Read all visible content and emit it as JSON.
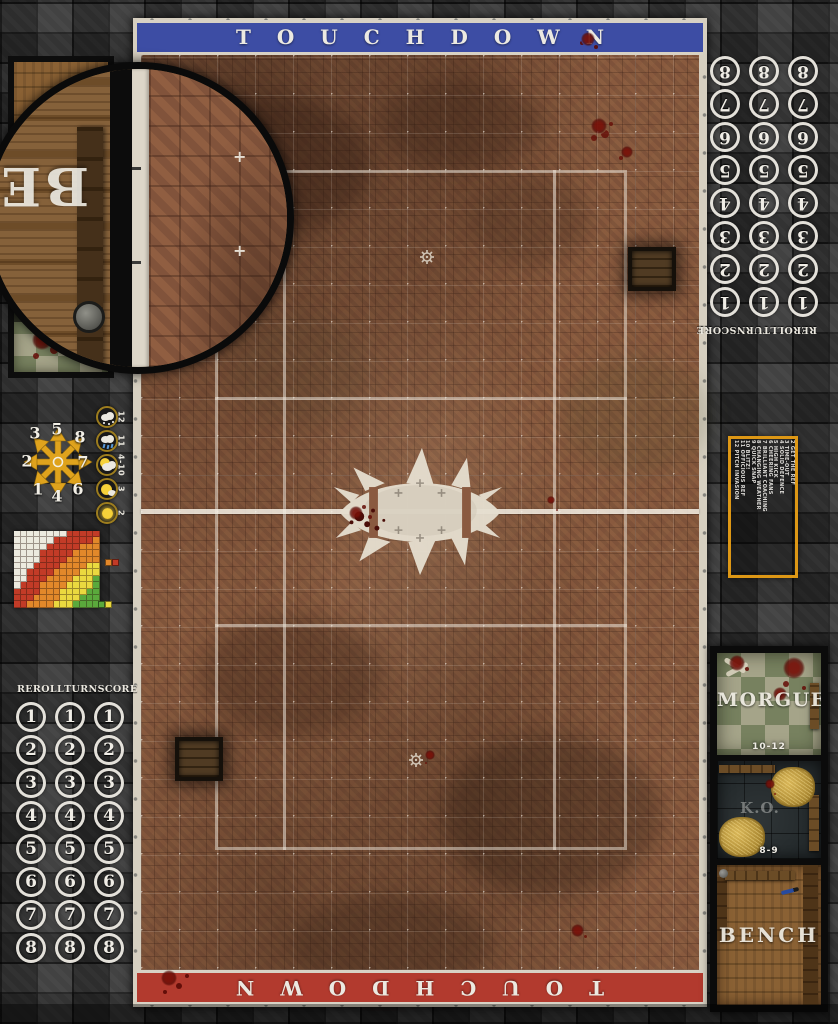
{
  "board": {
    "top_banner": {
      "label": "TOUCHDOWN",
      "color": "#3d4da4"
    },
    "bottom_banner": {
      "label": "TOUCHDOWN",
      "color": "#b23a2e"
    }
  },
  "turn_track": {
    "columns": [
      "REROLL",
      "TURN",
      "SCORE"
    ],
    "numbers": [
      "1",
      "2",
      "3",
      "4",
      "5",
      "6",
      "7",
      "8"
    ]
  },
  "scatter_template": {
    "numbers": [
      "1",
      "2",
      "3",
      "4",
      "5",
      "6",
      "7",
      "8"
    ]
  },
  "weather_track": {
    "entries": [
      {
        "value": "12",
        "icon": "blizzard-icon"
      },
      {
        "value": "11",
        "icon": "rain-icon"
      },
      {
        "value": "4-10",
        "icon": "overcast-icon"
      },
      {
        "value": "3",
        "icon": "sunny-icon"
      },
      {
        "value": "2",
        "icon": "sweltering-icon"
      }
    ]
  },
  "range_ruler": {
    "legend_colors": {
      "W": "#eceadf",
      "R": "#c23b27",
      "O": "#e2882a",
      "Y": "#ead93f",
      "G": "#5aa93c"
    },
    "rows": [
      "WWWWWWWWRRRRR",
      "WWWWWWRRRRRRO",
      "WWWWWRRRRROOO",
      "WWWWRRRRROOOO",
      "WWWWRRRROOOOO",
      "WWWRRRROOOOYY",
      "WWRRRROOOOYYY",
      "WWRRROOOOYYYG",
      "WRRROOOOYYYYG",
      "RRRROOOYYYYGG",
      "RRROOOOYYYGGG",
      "RROOOOYYYGGGG"
    ],
    "legend_top": [
      "O",
      "R"
    ],
    "legend_bottom": [
      "G",
      "Y"
    ]
  },
  "kickoff_table": {
    "entries": [
      "2 GET THE REF",
      "3 TIME-OUT",
      "4 SOLID DEFENCE",
      "5 HIGH KICK",
      "6 CHEERING FANS",
      "7 BRILLIANT COACHING",
      "8 CHANGING WEATHER",
      "9 QUICK SNAP",
      "10 BLITZ!",
      "11 OFFICIOUS REF",
      "12 PITCH INVASION"
    ]
  },
  "dugout": {
    "morgue_label": "MORGUE",
    "morgue_range": "10-12",
    "ko_label": "K.O.",
    "ko_range": "8-9",
    "bench_label": "BENCH"
  },
  "magnifier": {
    "visible_letters": "BE"
  }
}
